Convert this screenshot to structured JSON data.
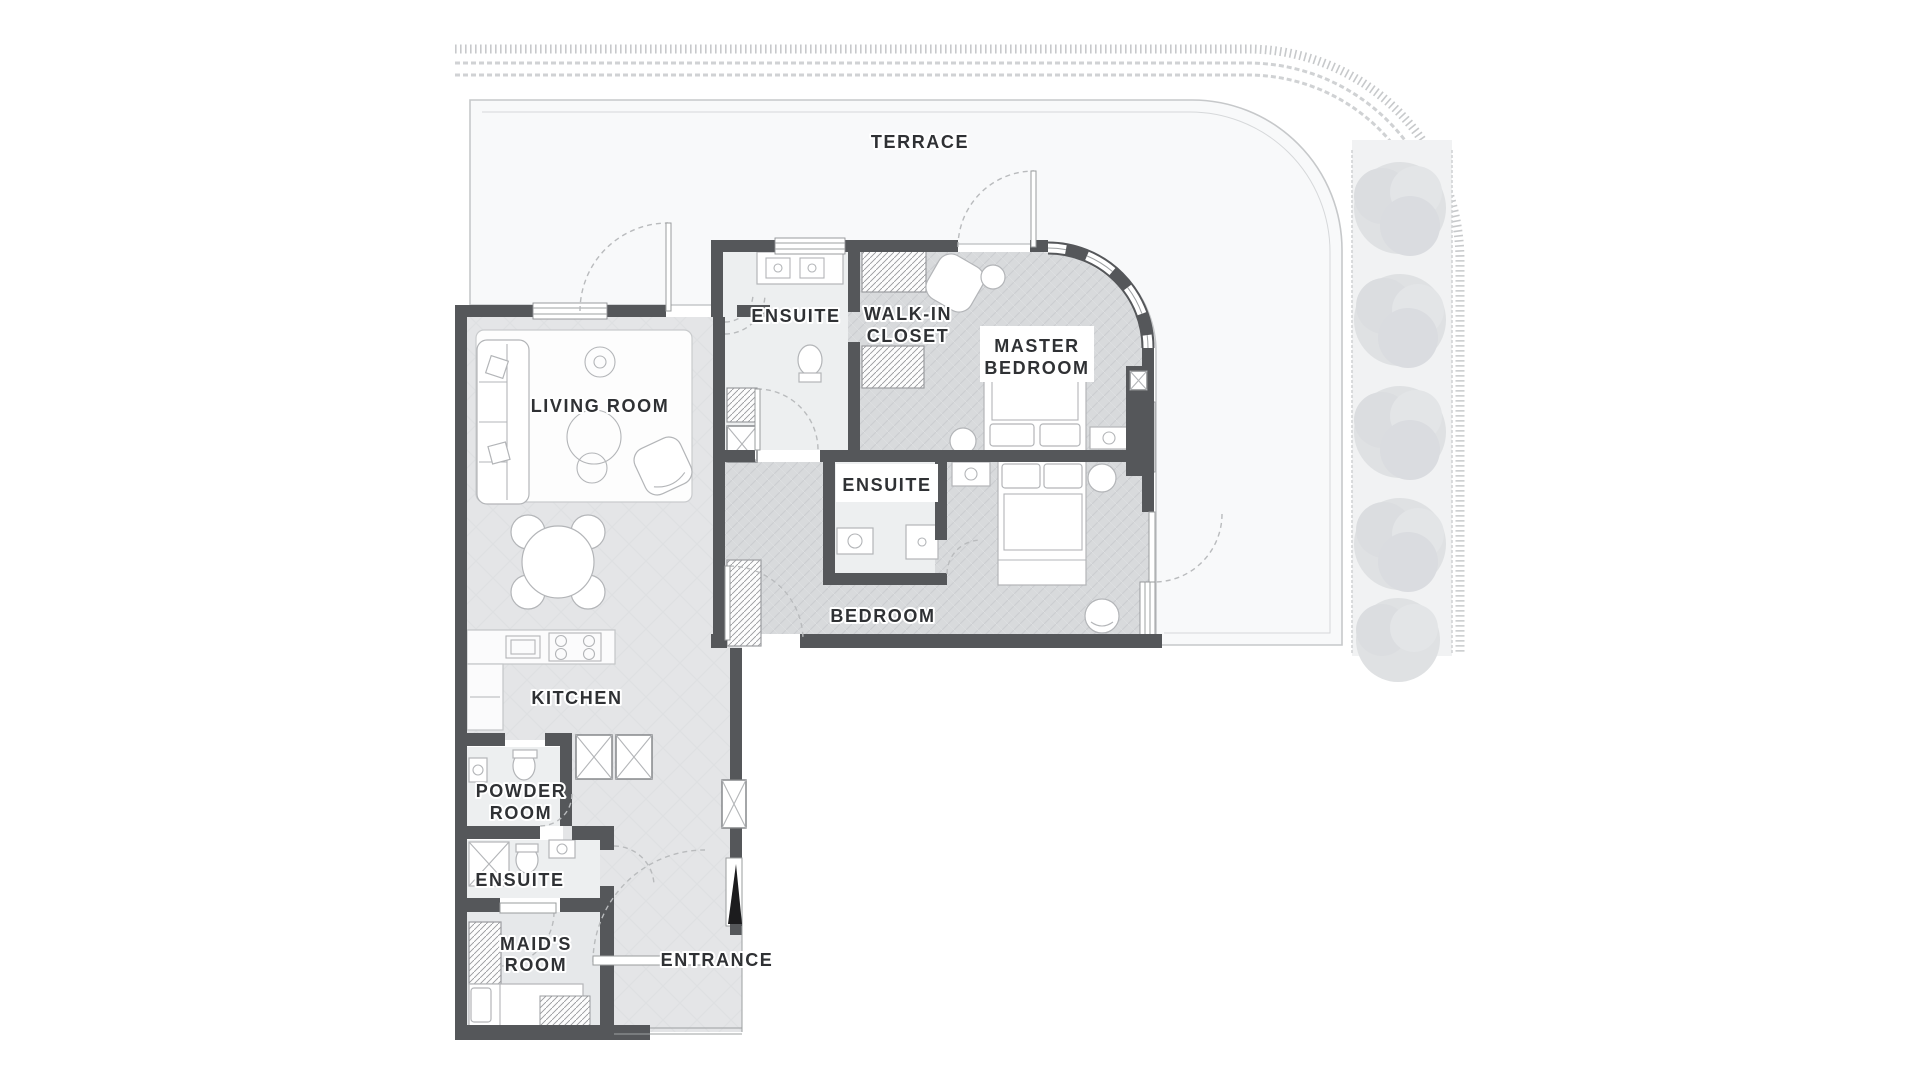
{
  "plan": {
    "kind": "apartment floor plan",
    "rooms_count": 12
  },
  "rooms": {
    "terrace": {
      "label": "TERRACE"
    },
    "master_ensuite": {
      "label": "ENSUITE"
    },
    "walk_in_closet": {
      "line1": "WALK-IN",
      "line2": "CLOSET"
    },
    "master_bedroom": {
      "line1": "MASTER",
      "line2": "BEDROOM"
    },
    "living_room": {
      "label": "LIVING ROOM"
    },
    "bedroom_ensuite": {
      "label": "ENSUITE"
    },
    "bedroom": {
      "label": "BEDROOM"
    },
    "kitchen": {
      "label": "KITCHEN"
    },
    "powder_room": {
      "line1": "POWDER",
      "line2": "ROOM"
    },
    "maid_ensuite": {
      "label": "ENSUITE"
    },
    "maids_room": {
      "line1": "MAID'S",
      "line2": "ROOM"
    },
    "entrance": {
      "label": "ENTRANCE"
    }
  },
  "colors": {
    "wall": "#55575a",
    "hall_floor": "#e4e5e7",
    "bedroom_floor": "#d8dadc",
    "bath_floor": "#edeff0",
    "terrace_floor": "#f8f9fa",
    "furniture": "#ffffff",
    "outline": "#b3b5b8",
    "decor_border": "#c9cbcd",
    "tree": "#dfe1e3",
    "label_text": "#2f3134",
    "entry_door": "#1c1c1e"
  },
  "trees": {
    "count": 5
  }
}
